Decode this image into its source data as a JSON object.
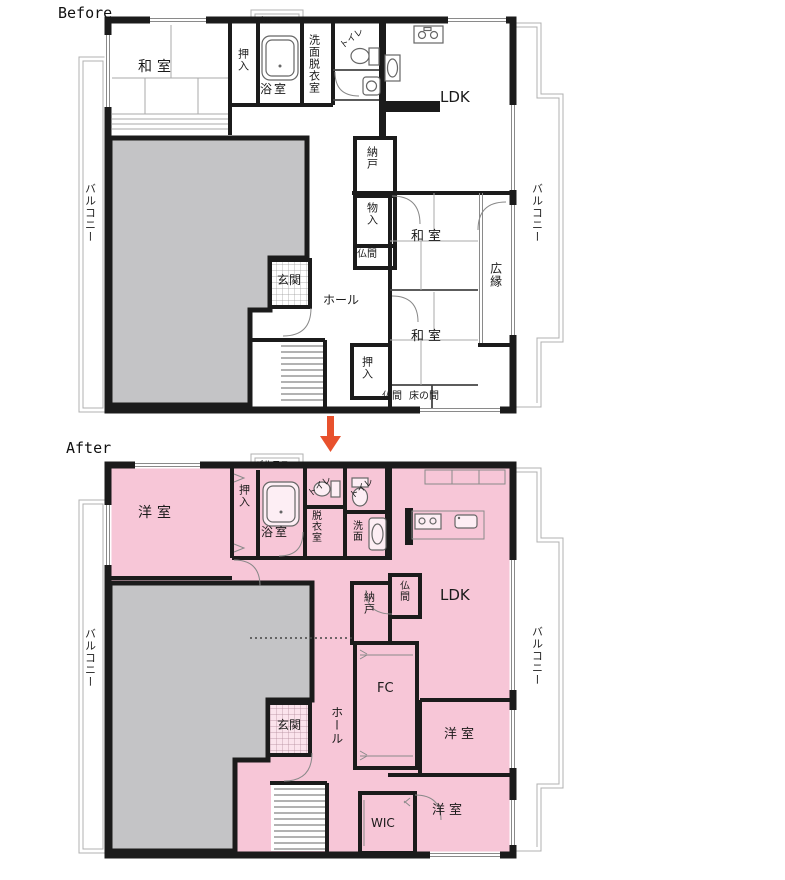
{
  "titles": {
    "before": "Before",
    "after": "After"
  },
  "arrow": {
    "direction": "down"
  },
  "colors": {
    "wall": "#1b1b1b",
    "after_fill": "#f7c6d7",
    "void_gray": "#c4c4c6",
    "balcony_line": "#b0b0b0",
    "arrow": "#e8512d",
    "tatami_line": "#aaaaaa",
    "fixture_line": "#666666"
  },
  "before": {
    "balcony_left": "バルコニー",
    "balcony_right": "バルコニー",
    "balcony_top": "バルコニー",
    "rooms": {
      "washitsu1": "和室",
      "oshiire1": "押入",
      "bath": "浴室",
      "senmen_datsuiishitsu": "洗面脱衣室",
      "toilet": "トイレ",
      "ldk": "LDK",
      "nando": "納戸",
      "monoire": "物入",
      "butsuma1": "仏間",
      "washitsu2": "和室",
      "hiroen": "広縁",
      "genkan": "玄関",
      "hall": "ホール",
      "washitsu3": "和室",
      "oshiire2": "押入",
      "butsuma2": "仏間",
      "tokonoma": "床の間"
    }
  },
  "after": {
    "balcony_left": "バルコニー",
    "balcony_right": "バルコニー",
    "balcony_top": "バルコニー",
    "rooms": {
      "yoshitsu1": "洋室",
      "oshiire": "押入",
      "bath": "浴室",
      "toilet1": "トイレ",
      "datsuiishitsu": "脱衣室",
      "toilet2": "トイレ",
      "senmen": "洗面",
      "ldk": "LDK",
      "butsuma": "仏間",
      "nando": "納戸",
      "fc": "FC",
      "hall": "ホール",
      "genkan": "玄関",
      "yoshitsu2": "洋室",
      "wic": "WIC",
      "yoshitsu3": "洋室"
    }
  }
}
